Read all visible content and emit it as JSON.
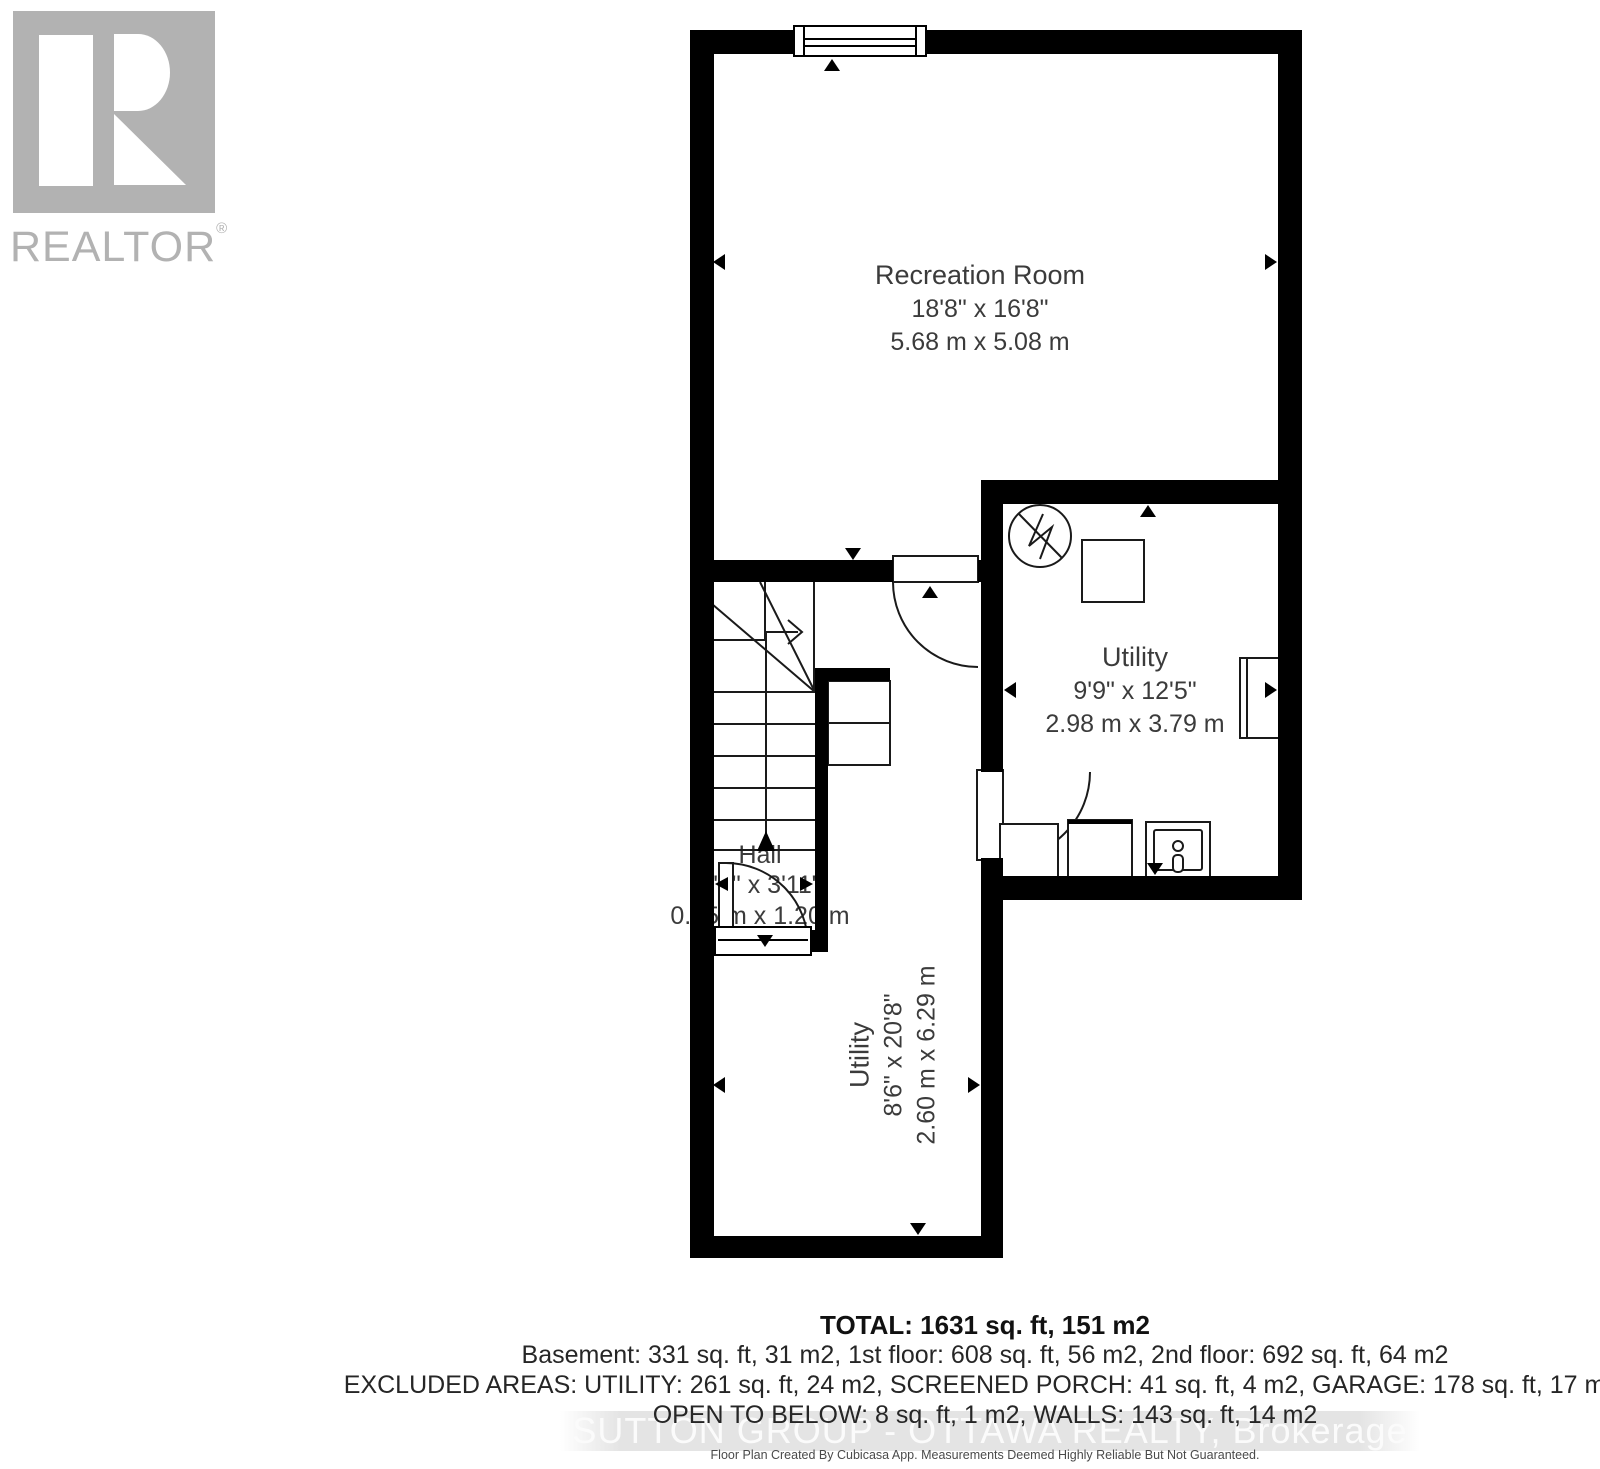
{
  "branding": {
    "logo_text": "REALTOR",
    "registered_mark": "®"
  },
  "rooms": {
    "recreation": {
      "name": "Recreation Room",
      "dim_ft": "18'8\" x 16'8\"",
      "dim_m": "5.68 m x 5.08 m"
    },
    "utility_right": {
      "name": "Utility",
      "dim_ft": "9'9\" x 12'5\"",
      "dim_m": "2.98 m x 3.79 m"
    },
    "hall": {
      "name": "Hall",
      "dim_ft": "3'1\" x 3'11\"",
      "dim_m": "0.95 m x 1.20 m"
    },
    "utility_lower": {
      "name": "Utility",
      "dim_ft": "8'6\" x 20'8\"",
      "dim_m": "2.60 m x 6.29 m"
    }
  },
  "summary": {
    "total": "TOTAL: 1631 sq. ft, 151 m2",
    "line1": "Basement: 331 sq. ft, 31 m2, 1st floor: 608 sq. ft, 56 m2, 2nd floor: 692 sq. ft, 64 m2",
    "line2": "EXCLUDED AREAS: UTILITY: 261 sq. ft, 24 m2, SCREENED PORCH: 41 sq. ft, 4 m2, GARAGE: 178 sq. ft, 17 m2,",
    "line3": "OPEN TO BELOW: 8 sq. ft, 1 m2, WALLS: 143 sq. ft, 14 m2"
  },
  "watermark": "SUTTON GROUP - OTTAWA REALTY, Brokerage",
  "disclaimer": "Floor Plan Created By Cubicasa App. Measurements Deemed Highly Reliable But Not Guaranteed.",
  "colors": {
    "wall": "#000000",
    "line": "#1a1a1a",
    "label_text": "#3b3b3b",
    "logo_gray": "#b2b2b2",
    "watermark_band": "#e4e4e4",
    "watermark_text": "#fbfbfb"
  }
}
